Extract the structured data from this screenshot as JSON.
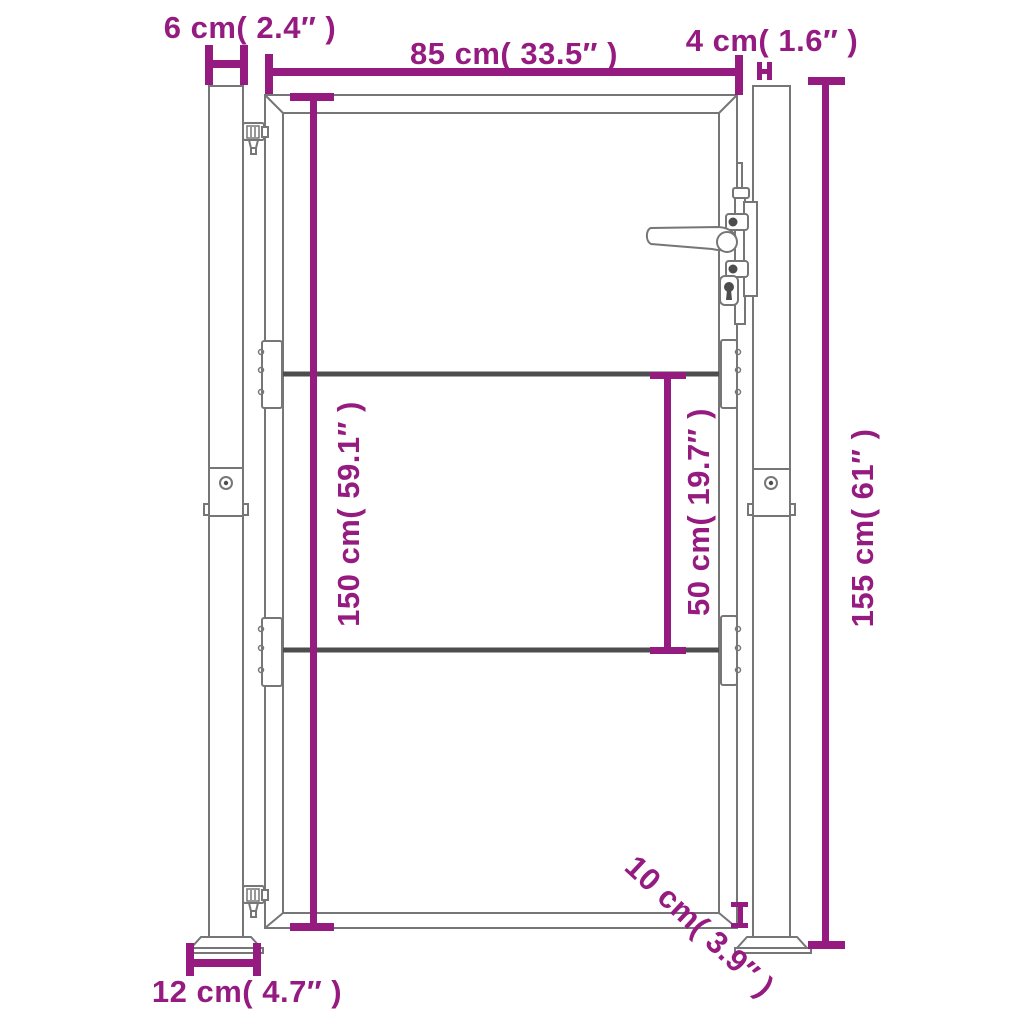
{
  "diagram": {
    "kind": "product dimension drawing",
    "subject": "garden gate with two square posts, two cross rails, lever handle with lock and hinges",
    "background_color": "#ffffff"
  },
  "colors": {
    "dimension": "#951b81",
    "outline": "#767676",
    "rail": "#4d4d4d",
    "hardware": "#4d4d4d"
  },
  "dimensions": {
    "post_width": {
      "label": "6 cm( 2.4″  )",
      "cm": "6",
      "inch": "2.4"
    },
    "gate_width": {
      "label": "85 cm( 33.5″  )",
      "cm": "85",
      "inch": "33.5"
    },
    "gap_width": {
      "label": "4 cm( 1.6″  )",
      "cm": "4",
      "inch": "1.6"
    },
    "gate_height": {
      "label": "150 cm( 59.1″  )",
      "cm": "150",
      "inch": "59.1"
    },
    "rail_spacing": {
      "label": "50 cm( 19.7″  )",
      "cm": "50",
      "inch": "19.7"
    },
    "post_height": {
      "label": "155 cm( 61″  )",
      "cm": "155",
      "inch": "61"
    },
    "base_plate_width": {
      "label": "12 cm( 4.7″  )",
      "cm": "12",
      "inch": "4.7"
    },
    "ground_clearance": {
      "label": "10 cm( 3.9″  )",
      "cm": "10",
      "inch": "3.9"
    }
  }
}
